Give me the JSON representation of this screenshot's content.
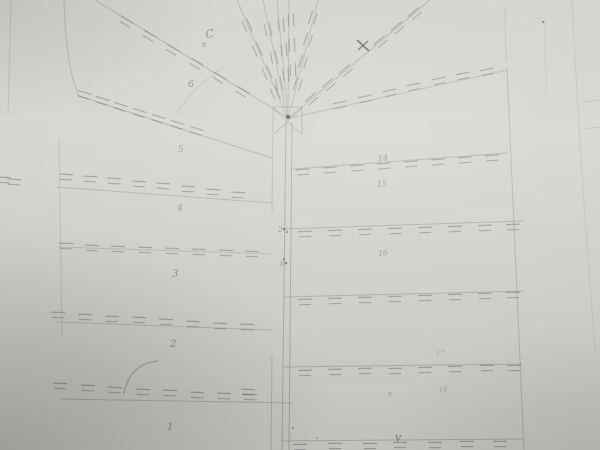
{
  "image": {
    "kind": "photograph-of-pencil-sketch",
    "subject": "hand-drawn cadastral parcel survey sketch",
    "width": 600,
    "height": 450
  },
  "paper": {
    "base_color": "#d5d4d0",
    "pencil_color": "#6e6e6a",
    "pencil_dark_color": "#4c4c49"
  },
  "drawing": {
    "labels": [
      {
        "text": "C",
        "x": 206,
        "y": 38,
        "size": 11,
        "rot": -8,
        "o": 0.75
      },
      {
        "text": "x",
        "x": 202,
        "y": 47,
        "size": 8,
        "rot": 0,
        "o": 0.7
      },
      {
        "text": "6",
        "x": 188,
        "y": 87,
        "size": 9,
        "rot": 0,
        "o": 0.7
      },
      {
        "text": "5",
        "x": 178,
        "y": 152,
        "size": 9,
        "rot": 0,
        "o": 0.6
      },
      {
        "text": "4",
        "x": 177,
        "y": 211,
        "size": 9,
        "rot": 0,
        "o": 0.6
      },
      {
        "text": "3",
        "x": 172,
        "y": 277,
        "size": 10,
        "rot": 0,
        "o": 0.7
      },
      {
        "text": "2",
        "x": 170,
        "y": 347,
        "size": 10,
        "rot": 0,
        "o": 0.7
      },
      {
        "text": "1",
        "x": 167,
        "y": 430,
        "size": 10,
        "rot": 0,
        "o": 0.65
      },
      {
        "text": "14",
        "x": 378,
        "y": 161,
        "size": 8,
        "rot": -5,
        "o": 0.65
      },
      {
        "text": "15",
        "x": 377,
        "y": 187,
        "size": 8,
        "rot": -5,
        "o": 0.6
      },
      {
        "text": "16",
        "x": 378,
        "y": 256,
        "size": 8,
        "rot": -5,
        "o": 0.6
      },
      {
        "text": "17",
        "x": 436,
        "y": 356,
        "size": 7,
        "rot": -5,
        "o": 0.4
      },
      {
        "text": "18",
        "x": 439,
        "y": 392,
        "size": 7,
        "rot": -5,
        "o": 0.45
      },
      {
        "text": "x",
        "x": 388,
        "y": 396,
        "size": 7,
        "rot": 0,
        "o": 0.5
      },
      {
        "text": "v",
        "x": 395,
        "y": 441,
        "size": 11,
        "rot": 0,
        "o": 0.8
      },
      {
        "text": "2",
        "x": 278,
        "y": 232,
        "size": 7,
        "rot": 0,
        "o": 0.6
      },
      {
        "text": "8",
        "x": 280,
        "y": 266,
        "size": 7,
        "rot": 0,
        "o": 0.6
      }
    ],
    "lines": [
      [
        11,
        0,
        8,
        115,
        0.22,
        1
      ],
      [
        79,
        96,
        272,
        158,
        0.35,
        1
      ],
      [
        57,
        187,
        272,
        203,
        0.3,
        1
      ],
      [
        58,
        247,
        272,
        254,
        0.25,
        1
      ],
      [
        56,
        322,
        272,
        330,
        0.3,
        1
      ],
      [
        60,
        399,
        293,
        403,
        0.35,
        1
      ],
      [
        59,
        140,
        62,
        336,
        0.2,
        1
      ],
      [
        286,
        122,
        282,
        450,
        0.4,
        1
      ],
      [
        292,
        122,
        289,
        450,
        0.4,
        1
      ],
      [
        273,
        107,
        272,
        212,
        0.25,
        1
      ],
      [
        272,
        355,
        271,
        450,
        0.3,
        1
      ],
      [
        273,
        107,
        302,
        107,
        0.35,
        1
      ],
      [
        302,
        107,
        302,
        134,
        0.35,
        1
      ],
      [
        273,
        108,
        301,
        134,
        0.28,
        1
      ],
      [
        302,
        108,
        274,
        134,
        0.28,
        1
      ],
      [
        95,
        0,
        287,
        117,
        0.35,
        1
      ],
      [
        237,
        0,
        287,
        117,
        0.3,
        1
      ],
      [
        263,
        0,
        287,
        116,
        0.28,
        1
      ],
      [
        277,
        0,
        288,
        115,
        0.28,
        1
      ],
      [
        289,
        0,
        288,
        112,
        0.3,
        1
      ],
      [
        318,
        0,
        289,
        116,
        0.28,
        1
      ],
      [
        430,
        0,
        290,
        117,
        0.35,
        1
      ],
      [
        507,
        70,
        290,
        118,
        0.3,
        1
      ],
      [
        293,
        169,
        507,
        153,
        0.35,
        1
      ],
      [
        283,
        229,
        523,
        221,
        0.35,
        1
      ],
      [
        284,
        297,
        523,
        291,
        0.33,
        1
      ],
      [
        284,
        367,
        523,
        364,
        0.35,
        1
      ],
      [
        281,
        441,
        523,
        439,
        0.35,
        1
      ],
      [
        507,
        68,
        524,
        450,
        0.3,
        1
      ],
      [
        505,
        8,
        506,
        62,
        0.2,
        1
      ],
      [
        583,
        102,
        600,
        100,
        0.22,
        1
      ],
      [
        585,
        129,
        600,
        127,
        0.22,
        1
      ],
      [
        545,
        20,
        546,
        100,
        0.15,
        1
      ]
    ],
    "paths": [
      {
        "d": "M64,0 C65,40 69,75 79,96",
        "o": 0.3,
        "w": 1
      },
      {
        "d": "M158,361 Q129,364 124,394",
        "o": 0.45,
        "w": 1.2
      },
      {
        "d": "M225,66 Q195,85 176,114",
        "o": 0.18,
        "w": 1
      },
      {
        "d": "M572,0 Q578,120 586,230 Q591,295 595,350",
        "o": 0.16,
        "w": 1
      },
      {
        "d": "M357,40 L369,51",
        "o": 0.75,
        "w": 1.6,
        "dark": true
      },
      {
        "d": "M368,41 L358,50",
        "o": 0.7,
        "w": 1.4,
        "dark": true
      }
    ],
    "ticks": [
      [
        84,
        95,
        17
      ],
      [
        102,
        101,
        17
      ],
      [
        120,
        107,
        17
      ],
      [
        139,
        113,
        17
      ],
      [
        158,
        119,
        17
      ],
      [
        177,
        125,
        17
      ],
      [
        196,
        131,
        17
      ],
      [
        4,
        180,
        3
      ],
      [
        14,
        182,
        3
      ],
      [
        66,
        177,
        3
      ],
      [
        90,
        179,
        3
      ],
      [
        114,
        181,
        3
      ],
      [
        139,
        184,
        3
      ],
      [
        163,
        186,
        3
      ],
      [
        188,
        189,
        3
      ],
      [
        213,
        192,
        3
      ],
      [
        238,
        195,
        3
      ],
      [
        66,
        246,
        2
      ],
      [
        92,
        248,
        2
      ],
      [
        118,
        249,
        2
      ],
      [
        145,
        250,
        2
      ],
      [
        172,
        251,
        2
      ],
      [
        199,
        252,
        2
      ],
      [
        226,
        253,
        2
      ],
      [
        252,
        254,
        2
      ],
      [
        58,
        315,
        2
      ],
      [
        85,
        317,
        2
      ],
      [
        112,
        319,
        2
      ],
      [
        139,
        320,
        2
      ],
      [
        166,
        322,
        2
      ],
      [
        193,
        324,
        2
      ],
      [
        220,
        326,
        2
      ],
      [
        247,
        327,
        2
      ],
      [
        60,
        386,
        2
      ],
      [
        88,
        388,
        2
      ],
      [
        115,
        390,
        2
      ],
      [
        143,
        392,
        2
      ],
      [
        170,
        393,
        2
      ],
      [
        197,
        395,
        2
      ],
      [
        224,
        396,
        2
      ],
      [
        250,
        397,
        2
      ],
      [
        126,
        22,
        31
      ],
      [
        149,
        36,
        31
      ],
      [
        172,
        50,
        31
      ],
      [
        196,
        64,
        31
      ],
      [
        219,
        78,
        31
      ],
      [
        242,
        92,
        31
      ],
      [
        247,
        26,
        66
      ],
      [
        257,
        50,
        66
      ],
      [
        267,
        73,
        66
      ],
      [
        275,
        93,
        66
      ],
      [
        268,
        30,
        78
      ],
      [
        274,
        58,
        78
      ],
      [
        279,
        84,
        78
      ],
      [
        281,
        25,
        85
      ],
      [
        284,
        50,
        85
      ],
      [
        286,
        75,
        85
      ],
      [
        291,
        20,
        88
      ],
      [
        292,
        45,
        88
      ],
      [
        293,
        70,
        88
      ],
      [
        313,
        18,
        -72
      ],
      [
        308,
        40,
        -72
      ],
      [
        303,
        62,
        -72
      ],
      [
        298,
        84,
        -72
      ],
      [
        415,
        14,
        -40
      ],
      [
        398,
        28,
        -40
      ],
      [
        381,
        42,
        -40
      ],
      [
        346,
        71,
        -40
      ],
      [
        329,
        85,
        -40
      ],
      [
        312,
        99,
        -40
      ],
      [
        340,
        105,
        -12
      ],
      [
        365,
        99,
        -12
      ],
      [
        390,
        93,
        -12
      ],
      [
        414,
        87,
        -12
      ],
      [
        439,
        81,
        -12
      ],
      [
        463,
        76,
        -12
      ],
      [
        487,
        72,
        -12
      ],
      [
        303,
        172,
        -4
      ],
      [
        330,
        170,
        -4
      ],
      [
        357,
        168,
        -4
      ],
      [
        384,
        166,
        -4
      ],
      [
        411,
        164,
        -4
      ],
      [
        438,
        162,
        -4
      ],
      [
        465,
        160,
        -4
      ],
      [
        492,
        158,
        -4
      ],
      [
        305,
        234,
        -2
      ],
      [
        335,
        233,
        -2
      ],
      [
        365,
        232,
        -2
      ],
      [
        395,
        231,
        -2
      ],
      [
        425,
        230,
        -2
      ],
      [
        455,
        229,
        -2
      ],
      [
        485,
        228,
        -2
      ],
      [
        513,
        227,
        -2
      ],
      [
        305,
        302,
        -1
      ],
      [
        335,
        301,
        -1
      ],
      [
        365,
        300,
        -1
      ],
      [
        395,
        299,
        -1
      ],
      [
        425,
        298,
        -1
      ],
      [
        455,
        297,
        -1
      ],
      [
        485,
        296,
        -1
      ],
      [
        513,
        295,
        -1
      ],
      [
        305,
        373,
        -1
      ],
      [
        335,
        372,
        -1
      ],
      [
        365,
        371,
        -1
      ],
      [
        395,
        371,
        -1
      ],
      [
        425,
        370,
        -1
      ],
      [
        455,
        369,
        -1
      ],
      [
        487,
        368,
        -1
      ],
      [
        514,
        368,
        -1
      ],
      [
        300,
        447,
        0
      ],
      [
        335,
        446,
        0
      ],
      [
        370,
        446,
        0
      ],
      [
        400,
        445,
        0
      ],
      [
        435,
        445,
        0
      ],
      [
        467,
        444,
        0
      ],
      [
        500,
        444,
        0
      ],
      [
        248,
        392,
        2
      ]
    ],
    "dots": [
      [
        288,
        117,
        2.2,
        0.85
      ],
      [
        543,
        22,
        1.2,
        0.5
      ],
      [
        284,
        229,
        1.3,
        0.6
      ],
      [
        287,
        232,
        1.1,
        0.5
      ],
      [
        284,
        259,
        1.2,
        0.6
      ],
      [
        286,
        263,
        1.3,
        0.6
      ],
      [
        293,
        428,
        1.0,
        0.45
      ],
      [
        317,
        438,
        0.9,
        0.4
      ]
    ]
  }
}
